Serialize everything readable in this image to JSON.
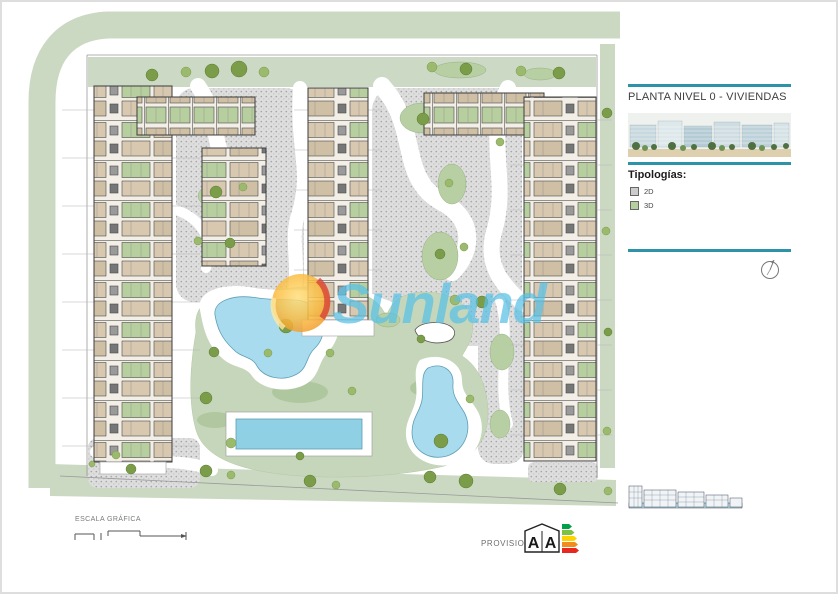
{
  "panel": {
    "title": "PLANTA NIVEL 0 - VIVIENDAS",
    "typologies_heading": "Tipologías:",
    "legend": [
      {
        "label": "2D",
        "color": "#cccccc"
      },
      {
        "label": "3D",
        "color": "#b7cf9f"
      }
    ],
    "accent_color": "#2d93a8"
  },
  "watermark": {
    "text": "Sunland",
    "color": "#57c1e6"
  },
  "footer": {
    "scale_label": "ESCALA GRÁFICA",
    "provisional_label": "PROVISIONAL",
    "energy": [
      "A",
      "A"
    ]
  },
  "plan_colors": {
    "road_band": "#cbd9c3",
    "lawn": "#c6d6ba",
    "gravel": "#dedede",
    "pool": "#a9dbee",
    "unit_2d": "#d8c8b0",
    "unit_3d": "#b7cf9f"
  }
}
